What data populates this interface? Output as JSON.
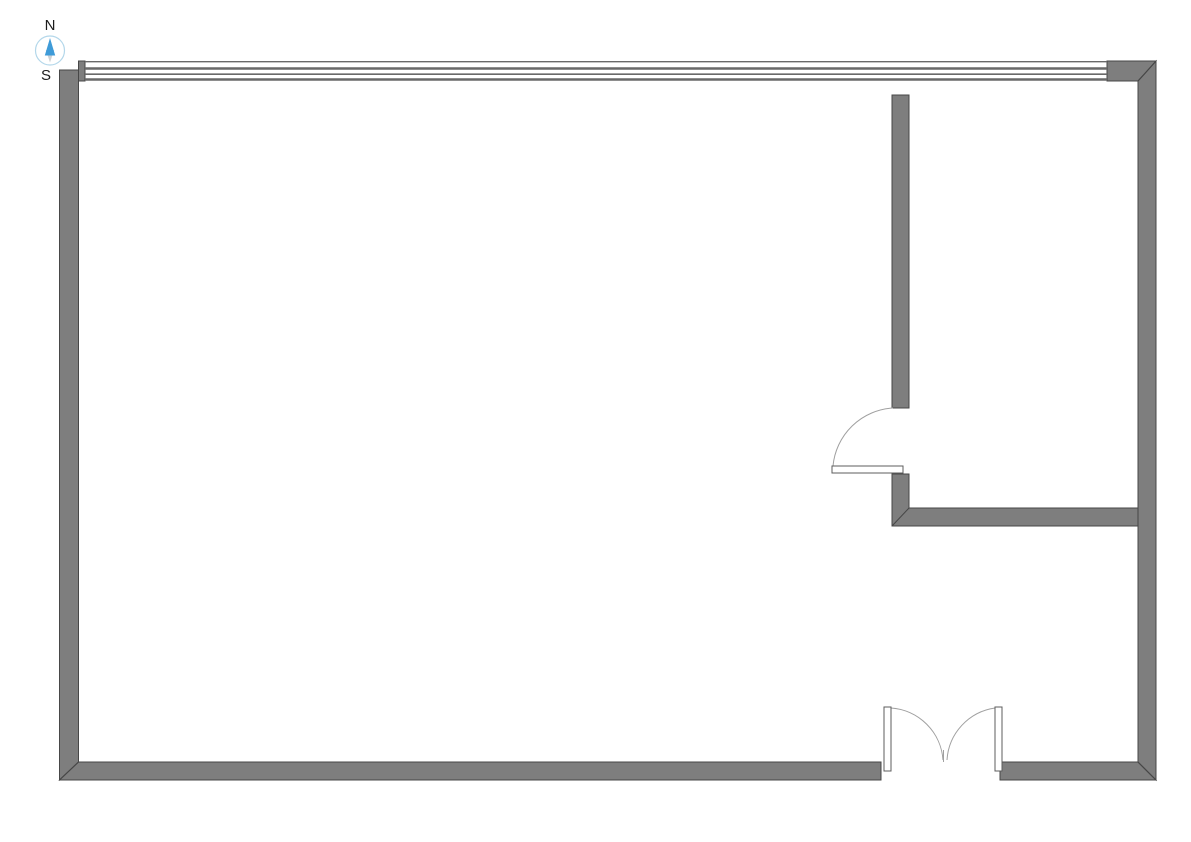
{
  "compass": {
    "north_label": "N",
    "south_label": "S"
  },
  "colors": {
    "background": "#ffffff",
    "wall_fill": "#7e7e7e",
    "wall_outline": "#474747",
    "window_line": "#696969",
    "door_outline": "#5c5c5c",
    "swing_arc": "#a0a0a0",
    "compass_ring": "#b3d7ea",
    "compass_north": "#3f9bd8",
    "compass_south": "#ccd1d5",
    "label_color": "#1c1c1c"
  },
  "plan": {
    "canvas": {
      "width": 1191,
      "height": 842
    },
    "wall_polygons": [
      {
        "name": "left-wall",
        "points": "59.5,70 78.5,70 78.5,762 59.5,780"
      },
      {
        "name": "bottom-wall-left",
        "points": "78.5,762 881,762 881,780 59.5,780"
      },
      {
        "name": "bottom-wall-right",
        "points": "1000,762 1138,762 1156,780 1000,780"
      },
      {
        "name": "right-wall",
        "points": "1138,81 1156,61 1156,780 1138,762"
      },
      {
        "name": "window-corner-block",
        "points": "1107,61 1156,61 1138,81 1107,81"
      },
      {
        "name": "window-left-cap",
        "points": "78.5,61 85,61 85,81 78.5,81"
      },
      {
        "name": "partition-wall-upper",
        "points": "892,95 909,95 909,408 892,408"
      },
      {
        "name": "partition-wall-lower",
        "points": "892,474 909,474 909,508 1138,508 1138,526 892,526"
      }
    ],
    "miter_lines": [
      {
        "name": "miter-bottom-left",
        "x1": 78.5,
        "y1": 762,
        "x2": 59.5,
        "y2": 780
      },
      {
        "name": "miter-bottom-right",
        "x1": 1138,
        "y1": 762,
        "x2": 1156,
        "y2": 780
      },
      {
        "name": "miter-top-right",
        "x1": 1138,
        "y1": 81,
        "x2": 1156,
        "y2": 61
      },
      {
        "name": "miter-partition",
        "x1": 892,
        "y1": 526,
        "x2": 909,
        "y2": 508
      }
    ],
    "window_lines": [
      {
        "x1": 85,
        "y1": 61.7,
        "x2": 1107,
        "y2": 61.7,
        "w": 1.4
      },
      {
        "x1": 85,
        "y1": 68.5,
        "x2": 1107,
        "y2": 68.5,
        "w": 2.4
      },
      {
        "x1": 85,
        "y1": 74.2,
        "x2": 1107,
        "y2": 74.2,
        "w": 1.6
      },
      {
        "x1": 85,
        "y1": 79.5,
        "x2": 1107,
        "y2": 79.5,
        "w": 2.4
      }
    ],
    "door_leaves": [
      {
        "name": "partition-door-leaf",
        "x": 832,
        "y": 466,
        "w": 71,
        "h": 7
      },
      {
        "name": "double-door-left-leaf",
        "x": 884,
        "y": 707,
        "w": 7,
        "h": 64
      },
      {
        "name": "double-door-right-leaf",
        "x": 995,
        "y": 707,
        "w": 7,
        "h": 64
      }
    ],
    "swing_arcs": [
      {
        "name": "partition-door-swing",
        "d": "M 893 408 A 64 64 0 0 0 833 466"
      },
      {
        "name": "double-door-left-swing",
        "d": "M 891 708 A 56 56 0 0 1 943 760"
      },
      {
        "name": "double-door-right-swing",
        "d": "M 995 708 A 56 56 0 0 0 947 760"
      }
    ],
    "ticks": [
      {
        "name": "double-door-meeting-tick",
        "x1": 943.5,
        "y1": 750,
        "x2": 943.5,
        "y2": 762
      }
    ]
  }
}
